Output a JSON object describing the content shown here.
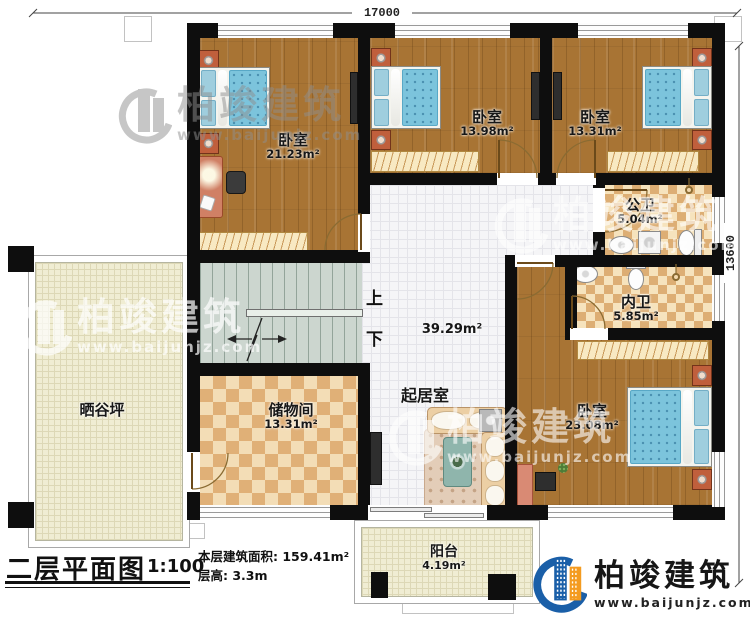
{
  "dimensions": {
    "width_mm": "17000",
    "height_mm": "13600"
  },
  "rooms": {
    "bedroom_tl": {
      "name": "卧室",
      "area": "21.23m²"
    },
    "bedroom_tm": {
      "name": "卧室",
      "area": "13.98m²"
    },
    "bedroom_tr": {
      "name": "卧室",
      "area": "13.31m²"
    },
    "public_bath": {
      "name": "公卫",
      "area": "5.04m²"
    },
    "ensuite_bath": {
      "name": "内卫",
      "area": "5.85m²"
    },
    "bedroom_br": {
      "name": "卧室",
      "area": "23.08m²"
    },
    "living": {
      "name": "起居室",
      "area": "39.29m²"
    },
    "storage": {
      "name": "储物间",
      "area": "13.31m²"
    },
    "terrace": {
      "name": "晒谷坪"
    },
    "balcony": {
      "name": "阳台",
      "area": "4.19m²"
    }
  },
  "stairs": {
    "up": "上",
    "down": "下"
  },
  "title_block": {
    "title": "二层平面图",
    "scale": "1:100",
    "area_line": "本层建筑面积: 159.41m²",
    "height_line": "层高: 3.3m"
  },
  "brand": {
    "icon": "building-swoosh-logo-icon",
    "name": "柏竣建筑",
    "website": "www.baijunjz.com"
  },
  "watermark": {
    "icon": "building-swoosh-watermark-icon",
    "name": "柏竣建筑",
    "website": "www.baijunjz.com"
  }
}
